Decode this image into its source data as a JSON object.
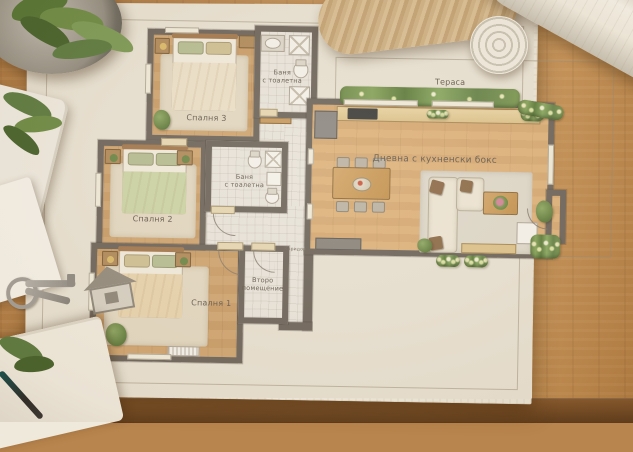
{
  "plan": {
    "terrace": {
      "label": "Тераса"
    },
    "living": {
      "label": "Дневна с кухненски бокс"
    },
    "bedroom1": {
      "label": "Спалня 1"
    },
    "bedroom2": {
      "label": "Спалня 2"
    },
    "bedroom3": {
      "label": "Спалня 3"
    },
    "bath_top": {
      "label_line1": "Баня",
      "label_line2": "с тоалетна"
    },
    "bath_middle": {
      "label_line1": "Баня",
      "label_line2": "с тоалетна"
    },
    "second_room": {
      "label_line1": "Второ",
      "label_line2": "помещение"
    },
    "corridor": {
      "label": "Коридор"
    }
  },
  "palette": {
    "wall": "#6f665c",
    "paper": "#f4efe6",
    "desk_wood": "#b9854e",
    "living_floor": "#d8ae77",
    "tile": "#e8e3da",
    "rug": "#e2d7c1",
    "plant_green": "#6d8748",
    "label_text": "#675d50"
  }
}
